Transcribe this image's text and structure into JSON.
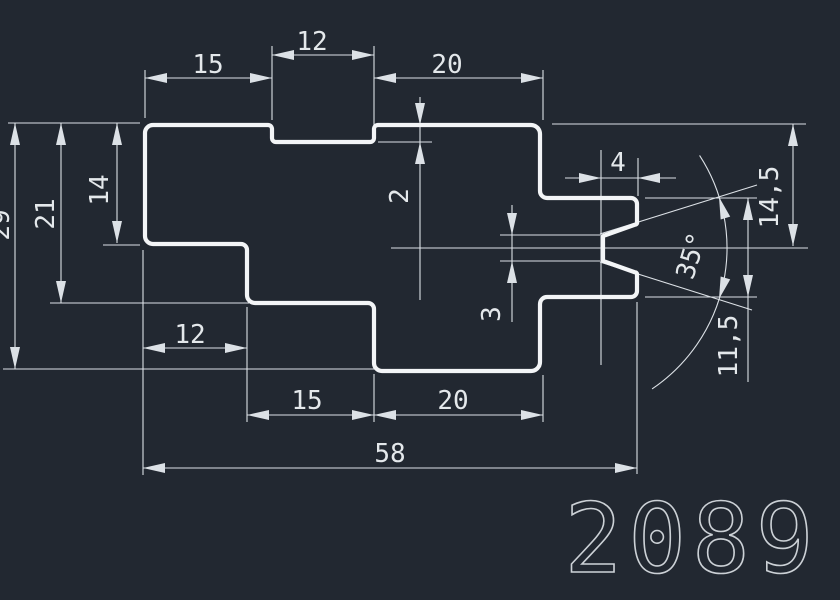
{
  "title": {
    "part_number": "2089"
  },
  "colors": {
    "background": "#222831",
    "outline": "#f3f5f7",
    "dims": "#dce1e6",
    "text": "#e4e8eb"
  },
  "drawing": {
    "dimension_values": {
      "top_widths": [
        "15",
        "12",
        "20"
      ],
      "top_step_depth": "2",
      "bottom_widths": [
        "12",
        "15",
        "20"
      ],
      "total_width": "58",
      "left_heights": [
        "14",
        "21",
        "29"
      ],
      "right_arm_offset_to_center": "14,5",
      "right_arm_height": "11,5",
      "notch_depth": "4",
      "notch_root_height": "3",
      "notch_angle": "35°"
    },
    "outline_points": [
      [
        145,
        125,
        8
      ],
      [
        272,
        125,
        4
      ],
      [
        272,
        142,
        4
      ],
      [
        374,
        142,
        4
      ],
      [
        374,
        125,
        4
      ],
      [
        540,
        125,
        9
      ],
      [
        540,
        198,
        7
      ],
      [
        637,
        198,
        6
      ],
      [
        637,
        224,
        2
      ],
      [
        603,
        236,
        2
      ],
      [
        603,
        261,
        2
      ],
      [
        637,
        273,
        2
      ],
      [
        637,
        297,
        6
      ],
      [
        540,
        297,
        7
      ],
      [
        540,
        371,
        9
      ],
      [
        374,
        371,
        8
      ],
      [
        374,
        303,
        6
      ],
      [
        247,
        303,
        8
      ],
      [
        247,
        244,
        6
      ],
      [
        145,
        244,
        8
      ]
    ],
    "thin_lines": [
      [
        8,
        123,
        140,
        123
      ],
      [
        145,
        70,
        145,
        118
      ],
      [
        272,
        46,
        272,
        120
      ],
      [
        374,
        46,
        374,
        138
      ],
      [
        543,
        70,
        543,
        120
      ],
      [
        552,
        124,
        806,
        124
      ],
      [
        378,
        142,
        432,
        142
      ],
      [
        145,
        78,
        272,
        78
      ],
      [
        272,
        55,
        374,
        55
      ],
      [
        374,
        78,
        543,
        78
      ],
      [
        420,
        97,
        420,
        300
      ],
      [
        15,
        123,
        15,
        369
      ],
      [
        61,
        123,
        61,
        303
      ],
      [
        117,
        123,
        117,
        243
      ],
      [
        103,
        245,
        140,
        245
      ],
      [
        50,
        303,
        249,
        303
      ],
      [
        3,
        369,
        378,
        369
      ],
      [
        143,
        250,
        143,
        475
      ],
      [
        247,
        307,
        247,
        422
      ],
      [
        374,
        374,
        374,
        422
      ],
      [
        543,
        375,
        543,
        422
      ],
      [
        637,
        302,
        637,
        474
      ],
      [
        143,
        348,
        247,
        348
      ],
      [
        247,
        415,
        543,
        415
      ],
      [
        143,
        468,
        637,
        468
      ],
      [
        391,
        248,
        808,
        248
      ],
      [
        512,
        205,
        512,
        322
      ],
      [
        500,
        235,
        600,
        235
      ],
      [
        500,
        261,
        600,
        261
      ],
      [
        565,
        178,
        676,
        178
      ],
      [
        601,
        150,
        601,
        365
      ],
      [
        638,
        158,
        638,
        196
      ],
      [
        793,
        124,
        793,
        246
      ],
      [
        748,
        198,
        748,
        382
      ],
      [
        645,
        198,
        757,
        198
      ],
      [
        645,
        297,
        757,
        297
      ],
      [
        600,
        234,
        757,
        185
      ],
      [
        600,
        262,
        752,
        310
      ]
    ],
    "arrows": [
      [
        145,
        78,
        180
      ],
      [
        272,
        78,
        0
      ],
      [
        272,
        55,
        180
      ],
      [
        374,
        55,
        0
      ],
      [
        374,
        78,
        180
      ],
      [
        543,
        78,
        0
      ],
      [
        420,
        125,
        90
      ],
      [
        420,
        142,
        -90
      ],
      [
        15,
        123,
        -90
      ],
      [
        15,
        369,
        90
      ],
      [
        61,
        123,
        -90
      ],
      [
        61,
        303,
        90
      ],
      [
        117,
        123,
        -90
      ],
      [
        117,
        243,
        90
      ],
      [
        143,
        348,
        180
      ],
      [
        247,
        348,
        0
      ],
      [
        247,
        415,
        180
      ],
      [
        374,
        415,
        0
      ],
      [
        374,
        415,
        180
      ],
      [
        543,
        415,
        0
      ],
      [
        143,
        468,
        180
      ],
      [
        637,
        468,
        0
      ],
      [
        601,
        178,
        0
      ],
      [
        638,
        178,
        180
      ],
      [
        512,
        235,
        90
      ],
      [
        512,
        261,
        -90
      ],
      [
        793,
        124,
        -90
      ],
      [
        793,
        246,
        90
      ],
      [
        748,
        198,
        -90
      ],
      [
        748,
        297,
        90
      ],
      [
        719,
        197,
        -107
      ],
      [
        719,
        299,
        107
      ]
    ],
    "angle_arc": {
      "cx": 557,
      "cy": 248,
      "r": 170,
      "start_deg": -33,
      "end_deg": 56
    },
    "texts": [
      {
        "t": "15",
        "x": 208,
        "y": 65,
        "rot": 0
      },
      {
        "t": "12",
        "x": 312,
        "y": 42,
        "rot": 0
      },
      {
        "t": "20",
        "x": 447,
        "y": 65,
        "rot": 0
      },
      {
        "t": "2",
        "x": 400,
        "y": 196,
        "rot": -90
      },
      {
        "t": "14",
        "x": 100,
        "y": 190,
        "rot": -90
      },
      {
        "t": "21",
        "x": 46,
        "y": 214,
        "rot": -90
      },
      {
        "t": "29",
        "x": 1,
        "y": 225,
        "rot": -90
      },
      {
        "t": "12",
        "x": 190,
        "y": 335,
        "rot": 0
      },
      {
        "t": "15",
        "x": 307,
        "y": 401,
        "rot": 0
      },
      {
        "t": "20",
        "x": 453,
        "y": 401,
        "rot": 0
      },
      {
        "t": "58",
        "x": 390,
        "y": 454,
        "rot": 0
      },
      {
        "t": "4",
        "x": 618,
        "y": 163,
        "rot": 0
      },
      {
        "t": "3",
        "x": 492,
        "y": 314,
        "rot": -90
      },
      {
        "t": "14,5",
        "x": 770,
        "y": 197,
        "rot": -90
      },
      {
        "t": "11,5",
        "x": 729,
        "y": 346,
        "rot": -90
      },
      {
        "t": "35°",
        "x": 692,
        "y": 256,
        "rot": -73
      }
    ]
  }
}
